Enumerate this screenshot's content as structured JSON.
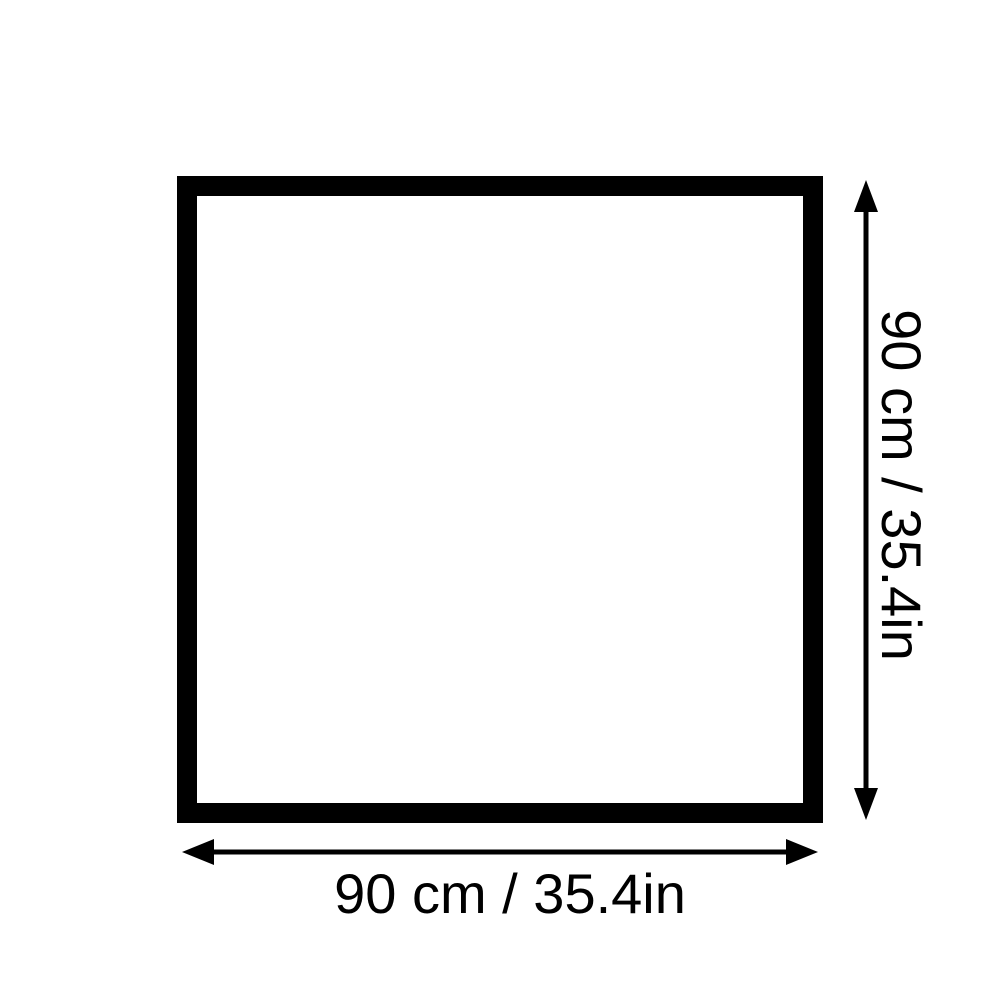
{
  "diagram": {
    "shape": "square",
    "width_label": "90 cm / 35.4in",
    "height_label": "90 cm / 35.4in",
    "colors": {
      "line": "#000000",
      "background": "#ffffff"
    }
  }
}
